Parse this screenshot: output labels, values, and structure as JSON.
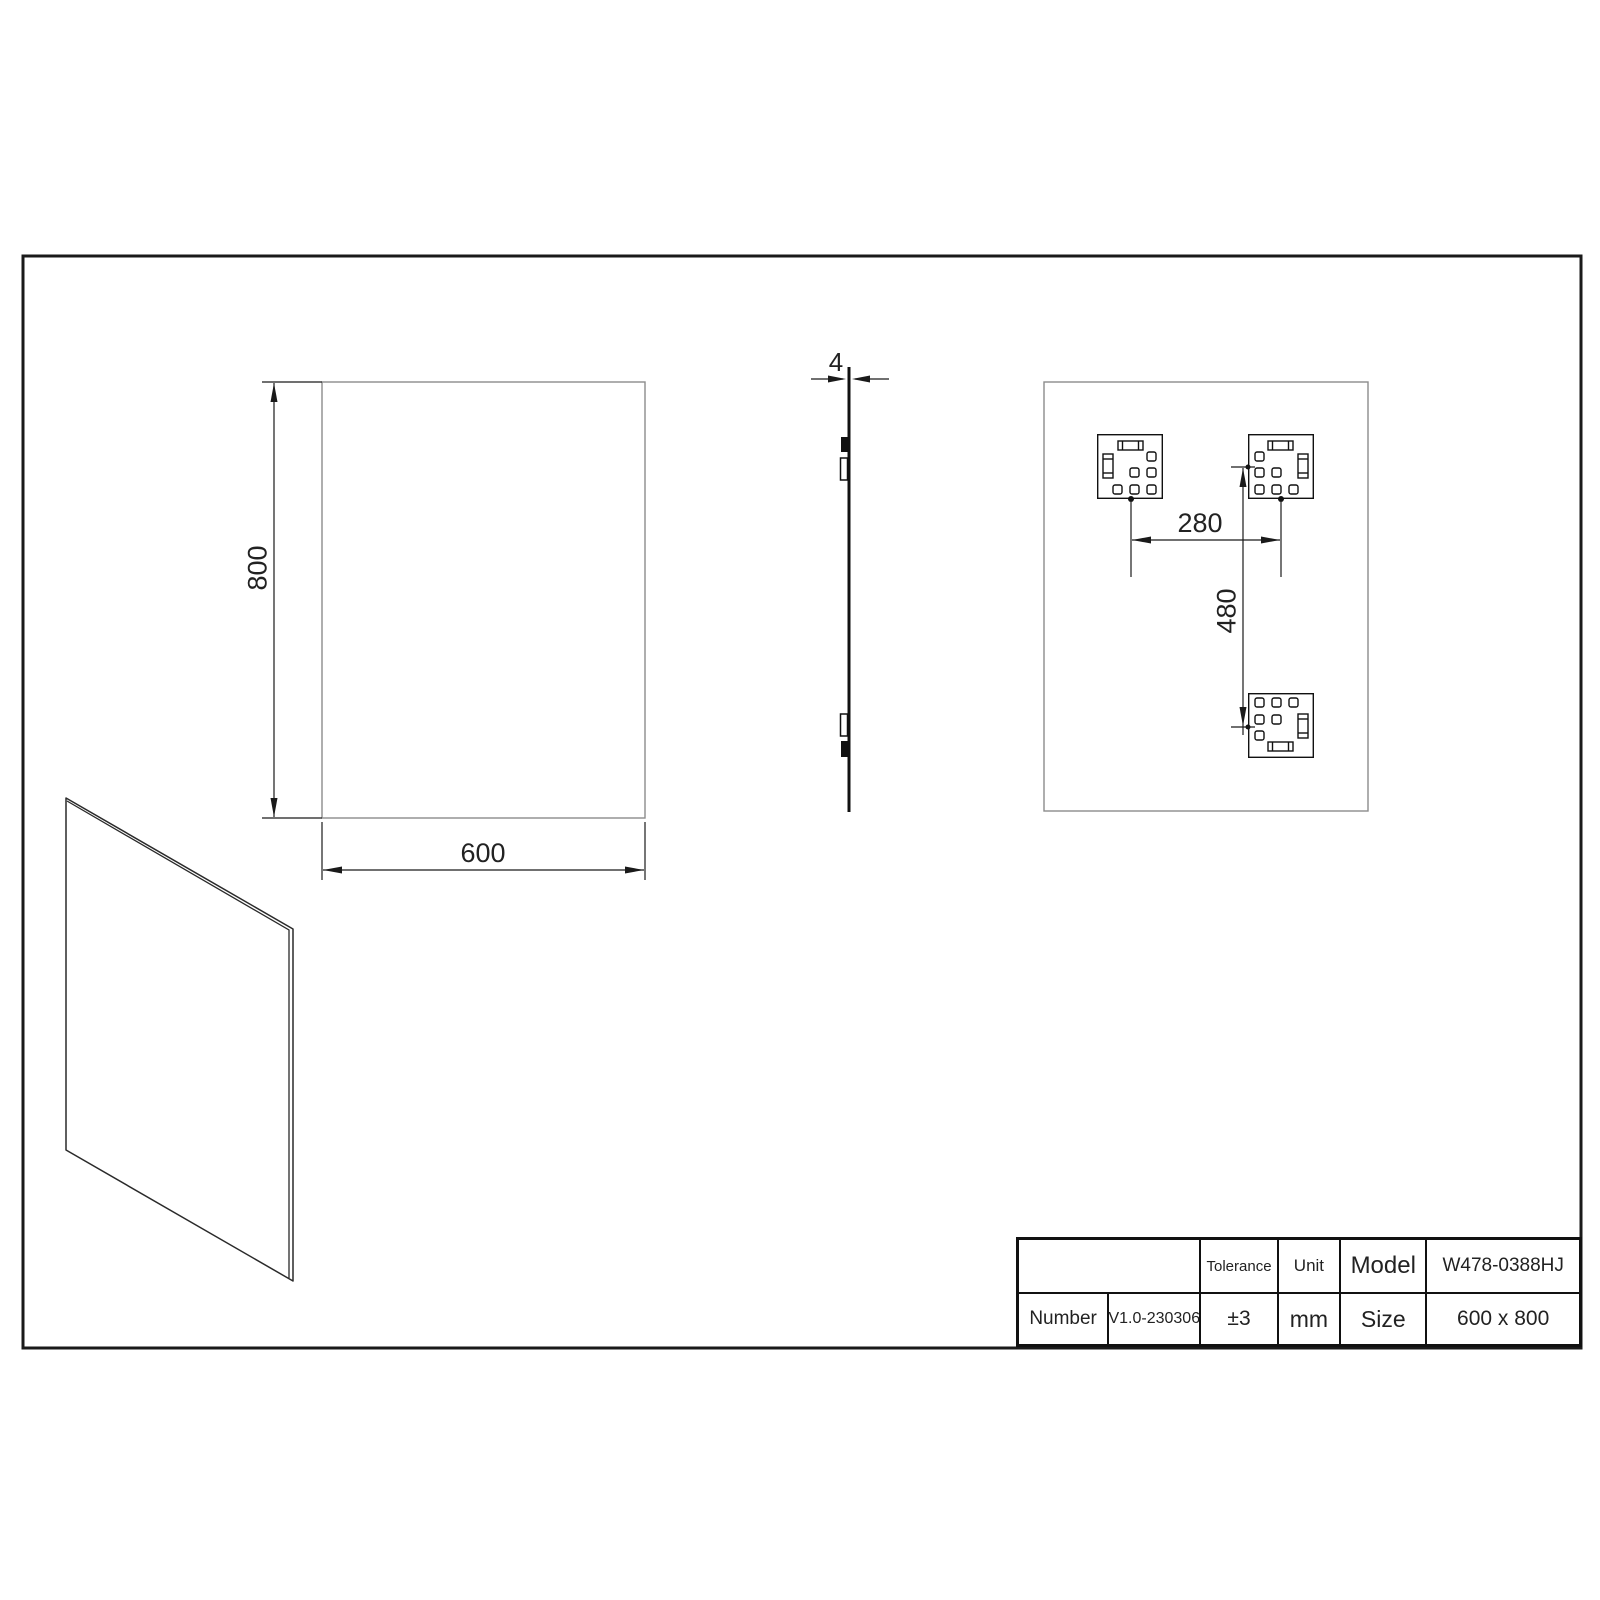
{
  "views": {
    "front": {
      "height_dim": "800",
      "width_dim": "600"
    },
    "side": {
      "thickness_dim": "4"
    },
    "back": {
      "horizontal_spacing_dim": "280",
      "vertical_spacing_dim": "480"
    }
  },
  "title_block": {
    "number_label": "Number",
    "number_value": "V1.0-230306",
    "tolerance_label": "Tolerance",
    "tolerance_value": "±3",
    "unit_label": "Unit",
    "unit_value": "mm",
    "model_label": "Model",
    "model_value": "W478-0388HJ",
    "size_label": "Size",
    "size_value": "600 x 800"
  },
  "colors": {
    "line_dark": "#1a1a1a",
    "line_gray": "#8c8c8c",
    "background": "#ffffff"
  }
}
